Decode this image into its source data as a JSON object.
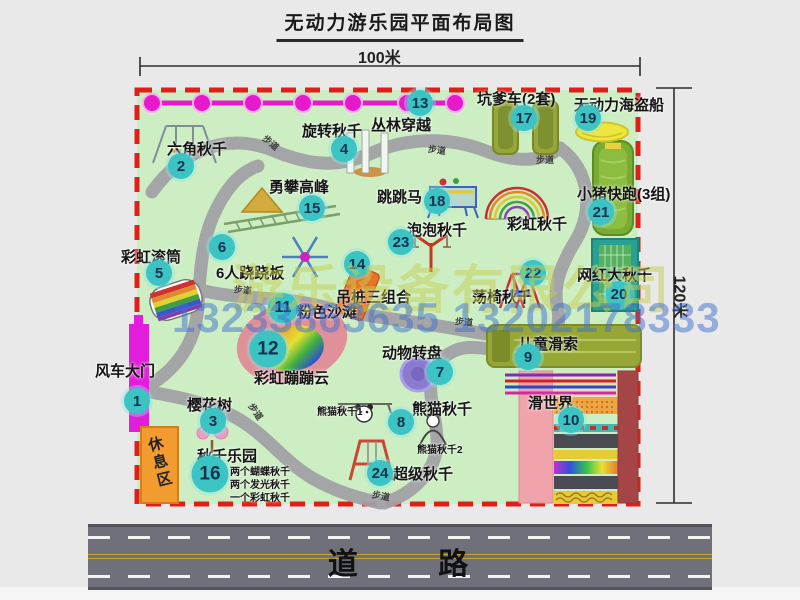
{
  "title": "无动力游乐园平面布局图",
  "dimensions": {
    "width_label": "100米",
    "height_label": "120米"
  },
  "road": {
    "label": "道 路"
  },
  "watermark": {
    "company": "游乐设备有限公司",
    "phone": "13233863635 13202178333"
  },
  "rest_area": {
    "label": "休息区"
  },
  "path_label": "步道",
  "rainbow_swing_label": "彩虹秋千",
  "colors": {
    "map_fill": "#cdeec2",
    "border_red": "#e02018",
    "badge_teal": "#3cc4c4",
    "zipline_magenta": "#e619cb",
    "gate_magenta": "#e21ddb",
    "rest_orange": "#f29b2e"
  },
  "attractions": [
    {
      "num": "1",
      "label": "风车大门"
    },
    {
      "num": "2",
      "label": "六角秋千"
    },
    {
      "num": "3",
      "label": "樱花树"
    },
    {
      "num": "4",
      "label": "旋转秋千"
    },
    {
      "num": "5",
      "label": "彩虹滚筒"
    },
    {
      "num": "6",
      "label": "6人跷跷板"
    },
    {
      "num": "7",
      "label": "动物转盘"
    },
    {
      "num": "8",
      "label": "熊猫秋千"
    },
    {
      "num": "9",
      "label": "儿童滑索"
    },
    {
      "num": "10",
      "label": "滑世界"
    },
    {
      "num": "11",
      "label": "粉色沙滩"
    },
    {
      "num": "12",
      "label": "彩虹蹦蹦云"
    },
    {
      "num": "13",
      "label": "丛林穿越"
    },
    {
      "num": "14",
      "label": "吊桩三组合"
    },
    {
      "num": "15",
      "label": "勇攀高峰"
    },
    {
      "num": "16",
      "label": "秋千乐园"
    },
    {
      "num": "17",
      "label": "坑爹车(2套)"
    },
    {
      "num": "18",
      "label": "跳跳马"
    },
    {
      "num": "19",
      "label": "无动力海盗船"
    },
    {
      "num": "20",
      "label": "网红大秋千"
    },
    {
      "num": "21",
      "label": "小猪快跑(3组)"
    },
    {
      "num": "22",
      "label": "荡椅秋千"
    },
    {
      "num": "23",
      "label": "泡泡秋千"
    },
    {
      "num": "24",
      "label": "超级秋千"
    }
  ],
  "swing_park_sub": [
    "两个蝴蝶秋千",
    "两个发光秋千",
    "一个彩虹秋千"
  ],
  "panda_sub": [
    "熊猫秋千1",
    "熊猫秋千2"
  ]
}
